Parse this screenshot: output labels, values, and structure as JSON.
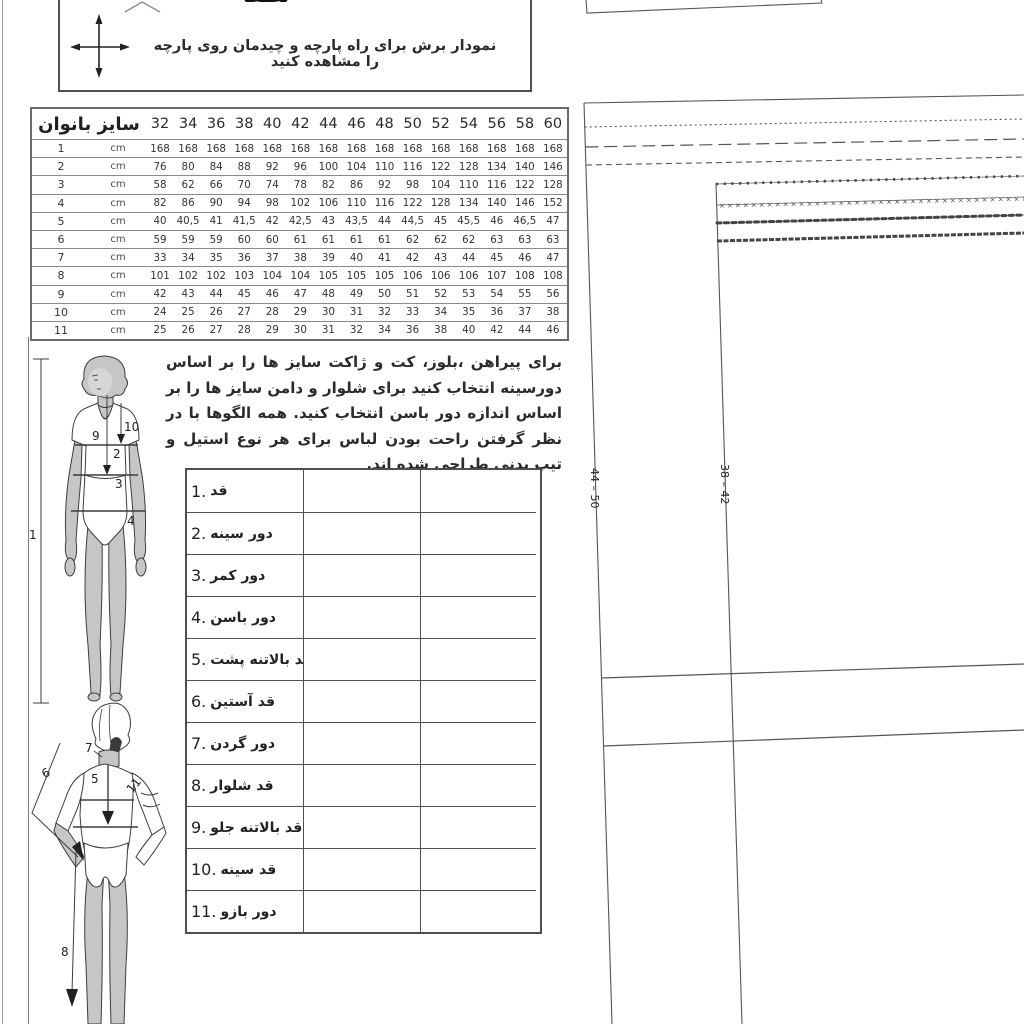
{
  "cutting_note": {
    "text": "نمودار برش برای راه پارچه و چیدمان روی پارچه را مشاهده کنید",
    "partial_top_text": "لطفا",
    "icon": "grainline-cross-arrows-icon"
  },
  "size_table": {
    "title": "سایز بانوان",
    "sizes": [
      "32",
      "34",
      "36",
      "38",
      "40",
      "42",
      "44",
      "46",
      "48",
      "50",
      "52",
      "54",
      "56",
      "58",
      "60"
    ],
    "rows": [
      {
        "num": "1",
        "unit": "cm",
        "values": [
          "168",
          "168",
          "168",
          "168",
          "168",
          "168",
          "168",
          "168",
          "168",
          "168",
          "168",
          "168",
          "168",
          "168",
          "168"
        ]
      },
      {
        "num": "2",
        "unit": "cm",
        "values": [
          "76",
          "80",
          "84",
          "88",
          "92",
          "96",
          "100",
          "104",
          "110",
          "116",
          "122",
          "128",
          "134",
          "140",
          "146"
        ]
      },
      {
        "num": "3",
        "unit": "cm",
        "values": [
          "58",
          "62",
          "66",
          "70",
          "74",
          "78",
          "82",
          "86",
          "92",
          "98",
          "104",
          "110",
          "116",
          "122",
          "128"
        ]
      },
      {
        "num": "4",
        "unit": "cm",
        "values": [
          "82",
          "86",
          "90",
          "94",
          "98",
          "102",
          "106",
          "110",
          "116",
          "122",
          "128",
          "134",
          "140",
          "146",
          "152"
        ]
      },
      {
        "num": "5",
        "unit": "cm",
        "values": [
          "40",
          "40,5",
          "41",
          "41,5",
          "42",
          "42,5",
          "43",
          "43,5",
          "44",
          "44,5",
          "45",
          "45,5",
          "46",
          "46,5",
          "47"
        ]
      },
      {
        "num": "6",
        "unit": "cm",
        "values": [
          "59",
          "59",
          "59",
          "60",
          "60",
          "61",
          "61",
          "61",
          "61",
          "62",
          "62",
          "62",
          "63",
          "63",
          "63"
        ]
      },
      {
        "num": "7",
        "unit": "cm",
        "values": [
          "33",
          "34",
          "35",
          "36",
          "37",
          "38",
          "39",
          "40",
          "41",
          "42",
          "43",
          "44",
          "45",
          "46",
          "47"
        ]
      },
      {
        "num": "8",
        "unit": "cm",
        "values": [
          "101",
          "102",
          "102",
          "103",
          "104",
          "104",
          "105",
          "105",
          "105",
          "106",
          "106",
          "106",
          "107",
          "108",
          "108"
        ]
      },
      {
        "num": "9",
        "unit": "cm",
        "values": [
          "42",
          "43",
          "44",
          "45",
          "46",
          "47",
          "48",
          "49",
          "50",
          "51",
          "52",
          "53",
          "54",
          "55",
          "56"
        ]
      },
      {
        "num": "10",
        "unit": "cm",
        "values": [
          "24",
          "25",
          "26",
          "27",
          "28",
          "29",
          "30",
          "31",
          "32",
          "33",
          "34",
          "35",
          "36",
          "37",
          "38"
        ]
      },
      {
        "num": "11",
        "unit": "cm",
        "values": [
          "25",
          "26",
          "27",
          "28",
          "29",
          "30",
          "31",
          "32",
          "34",
          "36",
          "38",
          "40",
          "42",
          "44",
          "46"
        ]
      }
    ]
  },
  "paragraph": "برای پیراهن ،بلوز، کت و ژاکت سایز ها را بر اساس دورسینه انتخاب کنید برای شلوار و دامن سایز ها را بر اساس اندازه دور باسن انتخاب کنید. همه الگوها با در نظر گرفتن راحت بودن لباس برای هر نوع استیل و تیپ بدنی طراحی شده اند.",
  "measurement_table": {
    "rows": [
      {
        "num": "1.",
        "label": "قد"
      },
      {
        "num": "2.",
        "label": "دور سینه"
      },
      {
        "num": "3.",
        "label": "دور کمر"
      },
      {
        "num": "4.",
        "label": "دور باسن"
      },
      {
        "num": "5.",
        "label": "قد بالاتنه پشت"
      },
      {
        "num": "6.",
        "label": "قد آستین"
      },
      {
        "num": "7.",
        "label": "دور گردن"
      },
      {
        "num": "8.",
        "label": "قد شلوار"
      },
      {
        "num": "9.",
        "label": "قد بالاتنه جلو"
      },
      {
        "num": "10.",
        "label": "قد سینه"
      },
      {
        "num": "11.",
        "label": "دور بازو"
      }
    ]
  },
  "figure_marks": {
    "height": "1",
    "bust": "2",
    "waist": "3",
    "hip": "4",
    "back_bodice": "5",
    "sleeve": "6",
    "neck": "7",
    "trouser": "8",
    "front_bodice": "9",
    "bust_length": "10",
    "arm": "11"
  },
  "pattern": {
    "left_size_range": "44 – 50",
    "right_size_range": "38 – 42"
  },
  "colors": {
    "line": "#555555",
    "skin": "#c6c6c6",
    "ink": "#2b2b2b"
  }
}
